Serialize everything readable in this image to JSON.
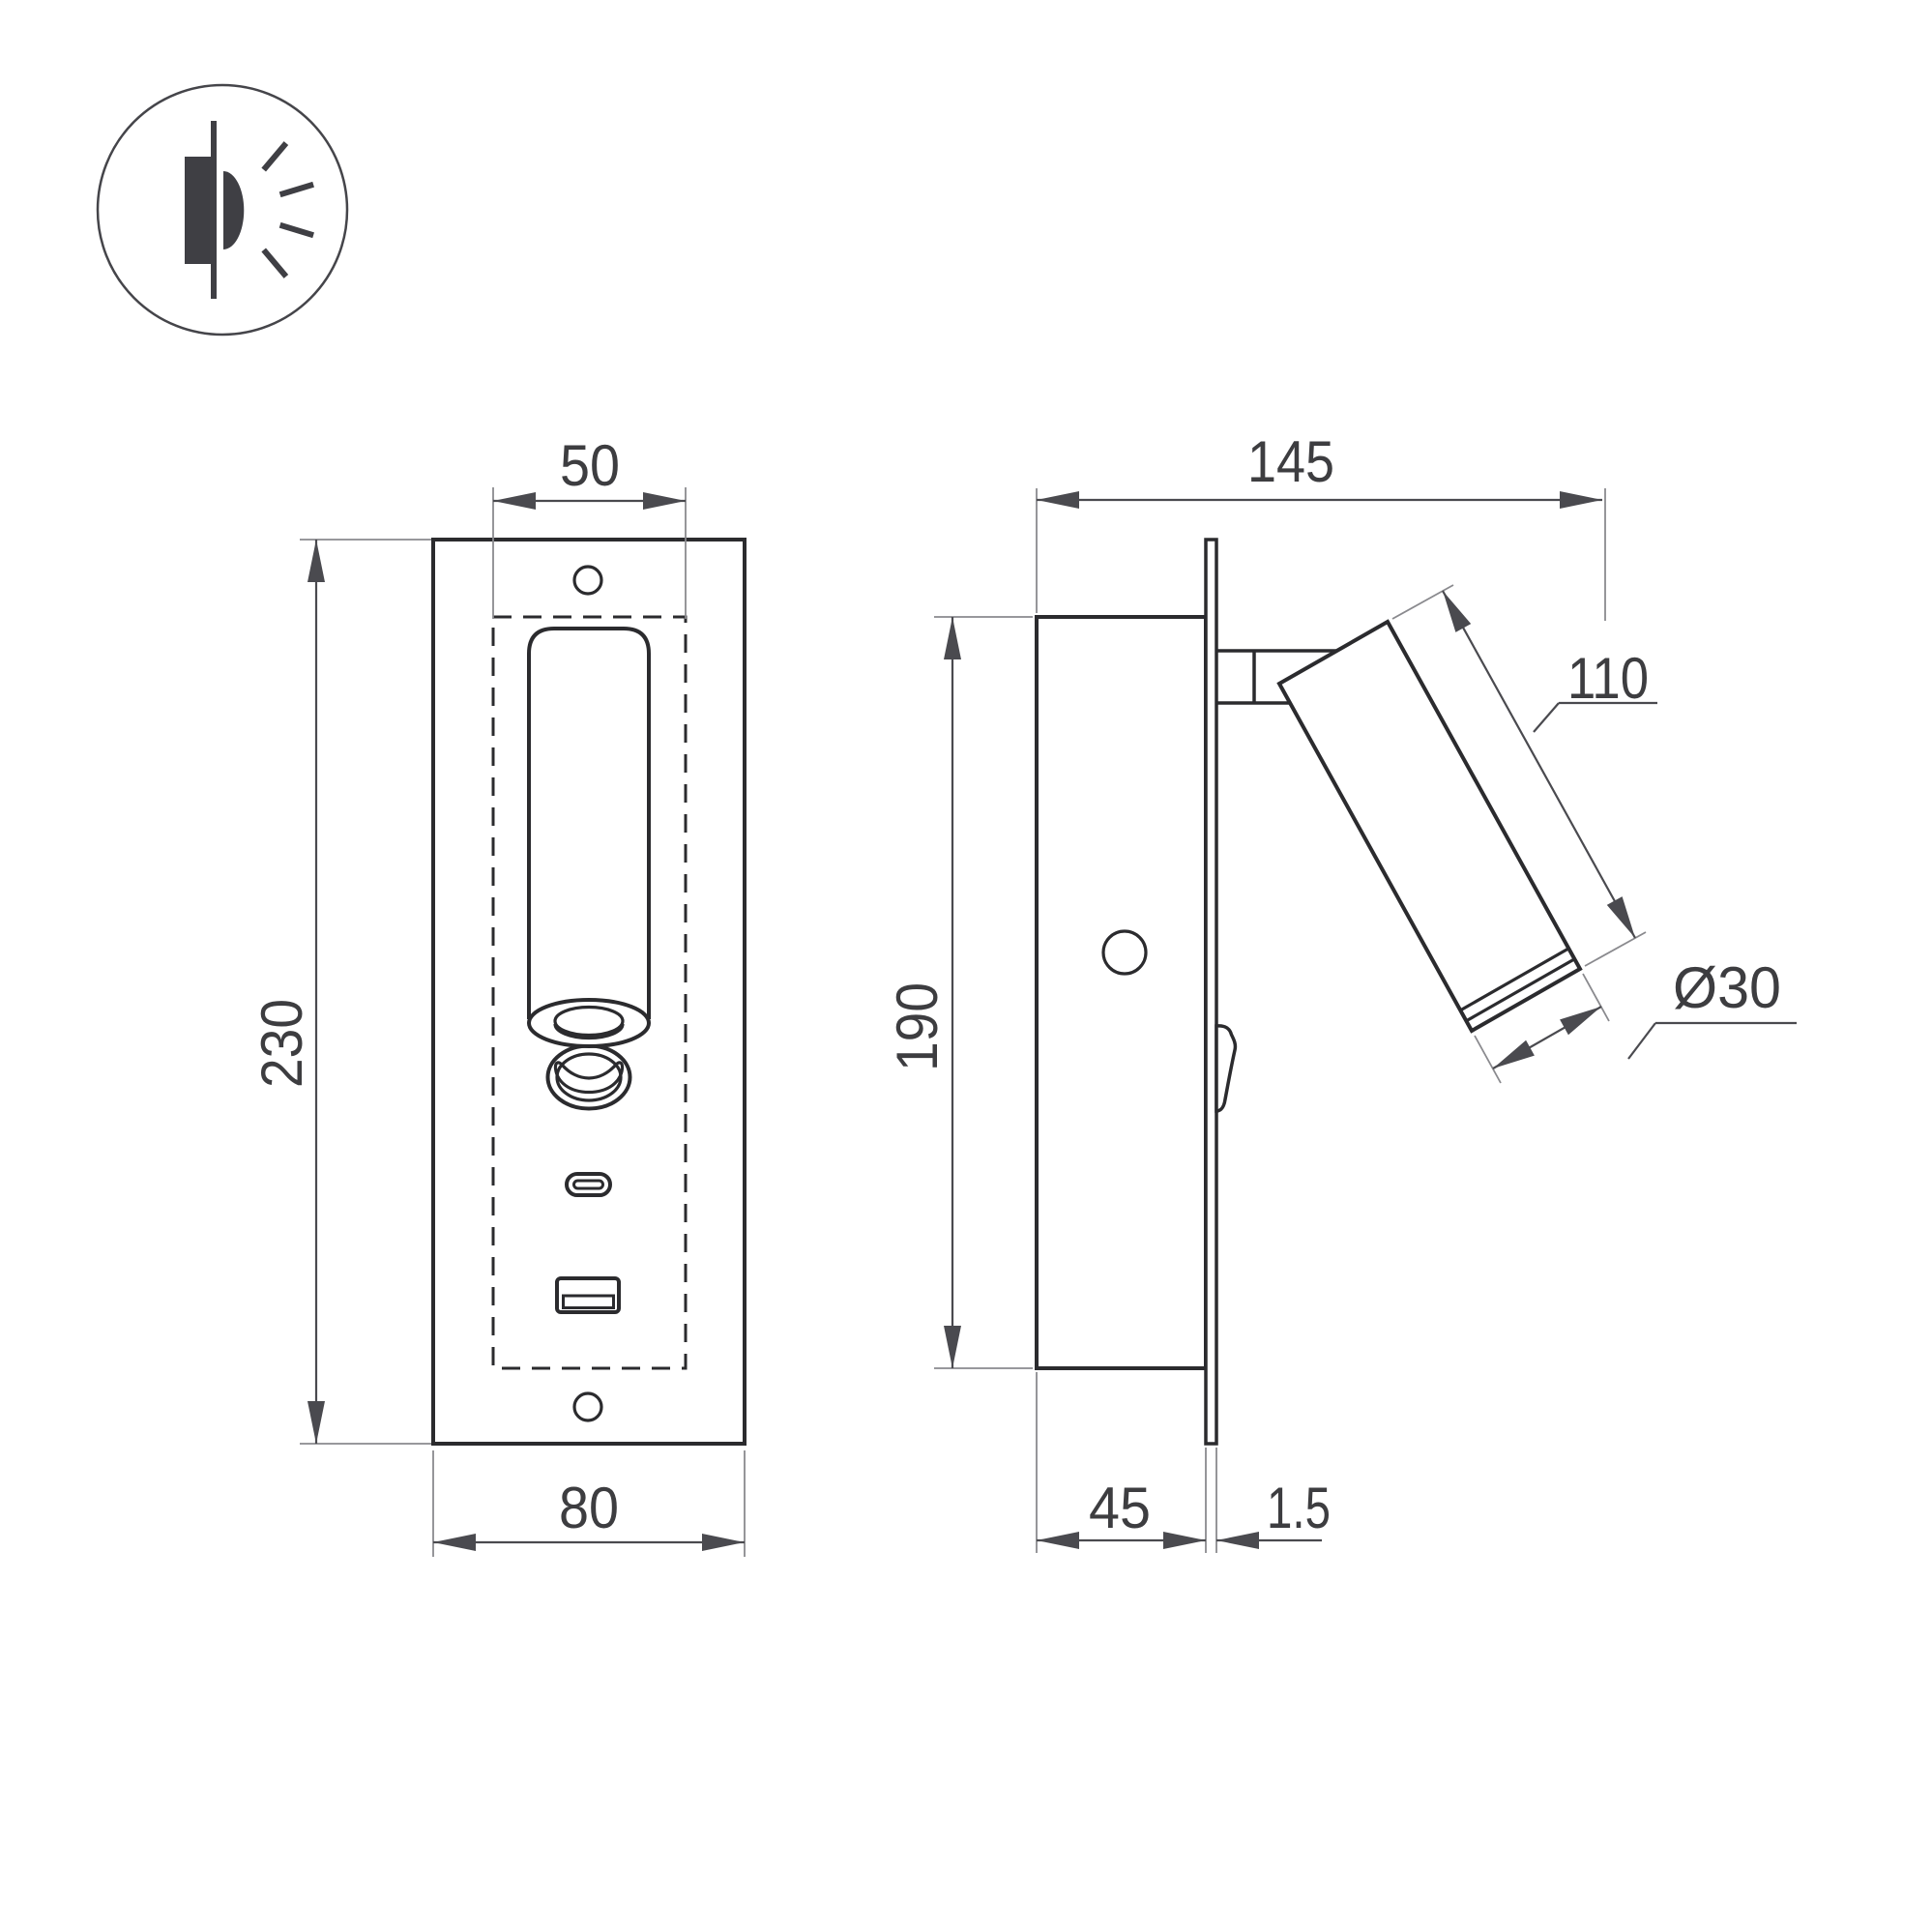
{
  "drawing": {
    "type": "technical-dimension-drawing",
    "subject": "recessed-wall-reading-light",
    "background": "#ffffff",
    "colors": {
      "outline": "#2b2b2e",
      "dimension_line": "#4a4a4f",
      "extension_line": "#8a8a8e",
      "label_text": "#3d3d40"
    }
  },
  "logo": {
    "icon": "recessed-wall-light-icon"
  },
  "front_view": {
    "name": "front view",
    "features": [
      "faceplate",
      "mounting-hole-top",
      "mounting-hole-bottom",
      "recess-cutout-dashed-outline",
      "spot-tube",
      "swivel-knob-ring",
      "usb-c-port",
      "usb-a-port"
    ],
    "dimensions": {
      "cutout_width": "50",
      "faceplate_height": "230",
      "faceplate_width": "80"
    }
  },
  "side_view": {
    "name": "side view",
    "features": [
      "recessed-housing",
      "faceplate-flange",
      "pivot-bracket",
      "tilted-spot-head",
      "toggle-switch",
      "housing-hole"
    ],
    "dimensions": {
      "total_depth": "145",
      "spot_length": "110",
      "spot_diameter": "Ø30",
      "housing_height": "190",
      "housing_depth": "45",
      "faceplate_thickness": "1.5"
    }
  }
}
